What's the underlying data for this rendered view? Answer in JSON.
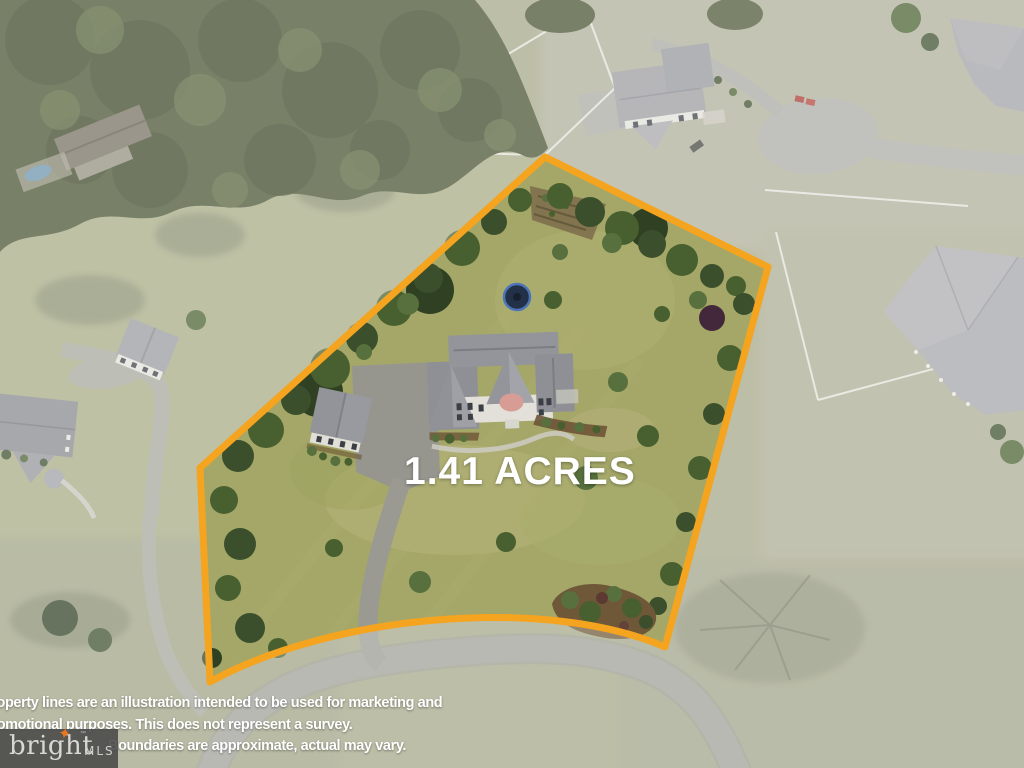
{
  "overlay": {
    "acreage_label": "1.41 ACRES",
    "disclaimer_lines": [
      "Property lines are an illustration intended to be used for marketing and",
      "promotional purposes. This does not represent a survey.",
      "Boundaries are approximate, actual may vary."
    ],
    "boundary_color": "#F5A41F",
    "text_color": "#FFFFFF"
  },
  "logo": {
    "brand": "bright",
    "star_glyph": "✦",
    "trademark": "™",
    "suffix": "MLS",
    "star_color": "#E87722",
    "panel_color": "#484848"
  },
  "scene": {
    "subject_lot": "1.41-acre lot outlined in orange",
    "features": [
      "two-story house",
      "detached garage",
      "asphalt driveway",
      "trampoline",
      "garden plot",
      "landscaped island",
      "tree-lined boundary",
      "neighboring homes",
      "cul-de-sac street",
      "white paddock fences",
      "wooded area",
      "neighbor pool"
    ]
  }
}
